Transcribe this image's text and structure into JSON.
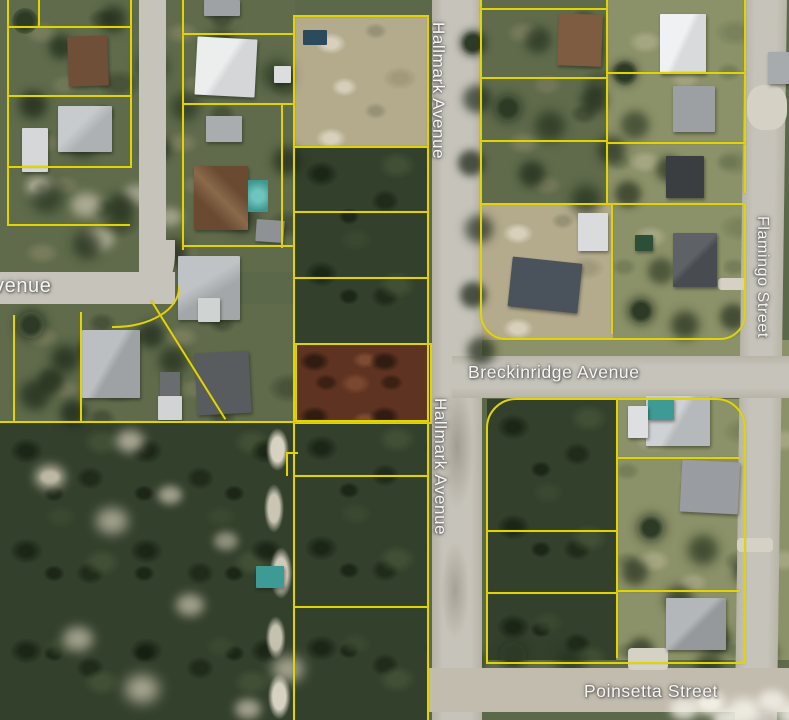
{
  "map": {
    "street_labels": {
      "left_avenue_partial": "venue",
      "hallmark_avenue_upper": "Hallmark Avenue",
      "hallmark_avenue_lower": "Hallmark Avenue",
      "flamingo_street": "Flamingo Street",
      "breckinridge_avenue": "Breckinridge Avenue",
      "poinsetta_street": "Poinsetta Street"
    },
    "colors": {
      "parcel_boundary_line": "#e0d405",
      "highlighted_parcel_fill": "#5e3321",
      "road_surface": "#c6c3ba"
    }
  }
}
